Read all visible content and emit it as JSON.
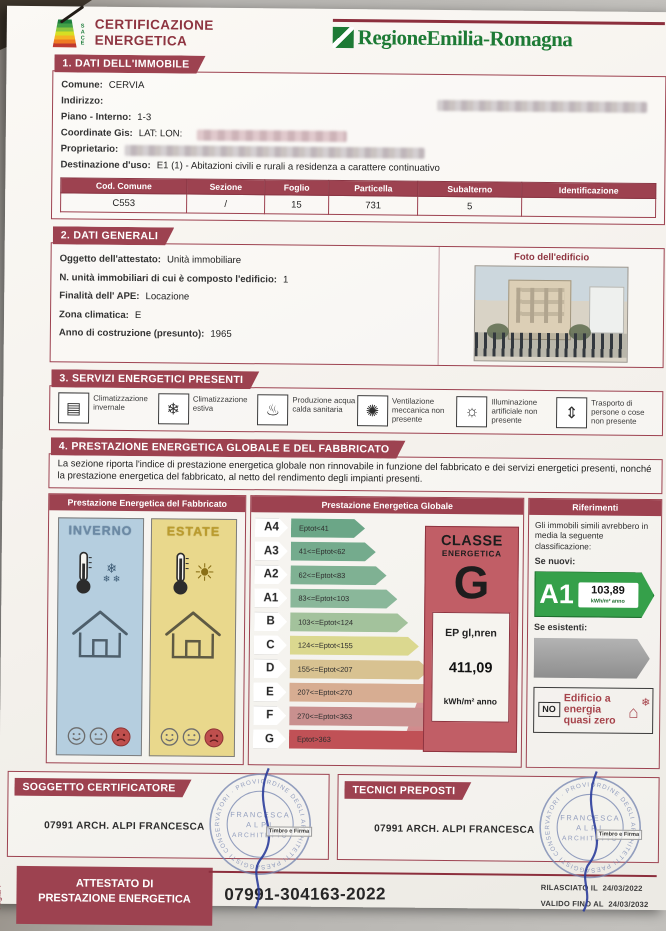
{
  "page": {
    "page_label": "Pag.1/4"
  },
  "header": {
    "cert_line1": "CERTIFICAZIONE",
    "cert_line2": "ENERGETICA",
    "sace_letters": [
      "S",
      "A",
      "C",
      "E"
    ],
    "region": "RegioneEmilia-Romagna"
  },
  "section1": {
    "title": "1. DATI DELL'IMMOBILE",
    "comune_label": "Comune:",
    "comune": "CERVIA",
    "indirizzo_label": "Indirizzo:",
    "piano_label": "Piano - Interno:",
    "piano": "1-3",
    "gis_label": "Coordinate Gis:",
    "gis": "LAT: LON:",
    "proprietario_label": "Proprietario:",
    "destinazione_label": "Destinazione d'uso:",
    "destinazione": "E1 (1) - Abitazioni civili e rurali a residenza a carattere continuativo",
    "table_headers": [
      "Cod. Comune",
      "Sezione",
      "Foglio",
      "Particella",
      "Subalterno",
      "Identificazione"
    ],
    "table_row": [
      "C553",
      "/",
      "15",
      "731",
      "5",
      ""
    ]
  },
  "section2": {
    "title": "2. DATI GENERALI",
    "oggetto_label": "Oggetto dell'attestato:",
    "oggetto": "Unità immobiliare",
    "nunita_label": "N. unità immobiliari di cui è composto l'edificio:",
    "nunita": "1",
    "finalita_label": "Finalità dell' APE:",
    "finalita": "Locazione",
    "zona_label": "Zona climatica:",
    "zona": "E",
    "anno_label": "Anno di costruzione (presunto):",
    "anno": "1965",
    "photo_label": "Foto dell'edificio"
  },
  "section3": {
    "title": "3. SERVIZI ENERGETICI PRESENTI",
    "services": [
      {
        "icon": "radiator-icon",
        "glyph": "▤",
        "label": "Climatizzazione invernale"
      },
      {
        "icon": "cooling-icon",
        "glyph": "❄",
        "label": "Climatizzazione estiva"
      },
      {
        "icon": "hot-water-icon",
        "glyph": "♨",
        "label": "Produzione acqua calda sanitaria"
      },
      {
        "icon": "ventilation-icon",
        "glyph": "✺",
        "label": "Ventilazione meccanica non presente"
      },
      {
        "icon": "lighting-icon",
        "glyph": "☼",
        "label": "Illuminazione artificiale non presente"
      },
      {
        "icon": "elevator-icon",
        "glyph": "⇕",
        "label": "Trasporto di persone o cose non presente"
      }
    ]
  },
  "section4": {
    "title": "4. PRESTAZIONE ENERGETICA GLOBALE E DEL FABBRICATO",
    "intro": "La sezione riporta l'indice di prestazione energetica globale non rinnovabile in funzione del fabbricato e dei servizi energetici presenti, nonché la prestazione energetica del fabbricato, al netto del rendimento degli impianti presenti.",
    "fabbricato_header": "Prestazione Energetica del Fabbricato",
    "inverno_title": "INVERNO",
    "estate_title": "ESTATE",
    "globale_header": "Prestazione Energetica Globale",
    "classes": [
      {
        "cls": "A4",
        "range": "Eptot<41",
        "color": "#6ba687",
        "w": "74px"
      },
      {
        "cls": "A3",
        "range": "41<=Eptot<62",
        "color": "#74ab8d",
        "w": "85px"
      },
      {
        "cls": "A2",
        "range": "62<=Eptot<83",
        "color": "#7fb193",
        "w": "96px"
      },
      {
        "cls": "A1",
        "range": "83<=Eptot<103",
        "color": "#8ab79a",
        "w": "107px"
      },
      {
        "cls": "B",
        "range": "103<=Eptot<124",
        "color": "#a3c29c",
        "w": "118px"
      },
      {
        "cls": "C",
        "range": "124<=Eptot<155",
        "color": "#dbd88f",
        "w": "129px"
      },
      {
        "cls": "D",
        "range": "155<=Eptot<207",
        "color": "#d8c291",
        "w": "140px"
      },
      {
        "cls": "E",
        "range": "207<=Eptot<270",
        "color": "#d7ad92",
        "w": "151px"
      },
      {
        "cls": "F",
        "range": "270<=Eptot<363",
        "color": "#c9908f",
        "w": "162px"
      },
      {
        "cls": "G",
        "range": "Eptot>363",
        "color": "#c05156",
        "w": "178px"
      }
    ],
    "classe_box": {
      "title1": "CLASSE",
      "title2": "ENERGETICA",
      "letter": "G",
      "ep_label": "EP gl,nren",
      "ep_value": "411,09",
      "ep_unit": "kWh/m² anno"
    },
    "riferimenti_header": "Riferimenti",
    "rif_text": "Gli immobili simili avrebbero in media la seguente classificazione:",
    "se_nuovi": "Se nuovi:",
    "nuovi_cls": "A1",
    "nuovi_val": "103,89",
    "nuovi_unit": "kWh/m² anno",
    "se_esistenti": "Se esistenti:",
    "nzeb_no": "NO",
    "nzeb_text": "Edificio a energia quasi zero"
  },
  "footer": {
    "soggetto_title": "SOGGETTO CERTIFICATORE",
    "soggetto_name": "07991 ARCH. ALPI FRANCESCA",
    "tecnici_title": "TECNICI PREPOSTI",
    "tecnici_name": "07991 ARCH. ALPI FRANCESCA",
    "stamp_ring": "ORDINE DEGLI ARCHITETTI PAESAGGISTI CONSERVATORI · PROVINCIA DI RAVENNA ·",
    "stamp_center1": "FRANCESCA",
    "stamp_center2": "ALPI",
    "stamp_center3": "ARCHITETTO",
    "timbro_label": "Timbro e Firma",
    "attestato_title1": "ATTESTATO DI",
    "attestato_title2": "PRESTAZIONE ENERGETICA",
    "code": "07991-304163-2022",
    "rilasciato_label": "RILASCIATO IL",
    "rilasciato_date": "24/03/2022",
    "valido_label": "VALIDO FINO AL",
    "valido_date": "24/03/2032"
  },
  "colors": {
    "banner_red": "#9d4250",
    "region_green": "#1d7a35",
    "classe_box_bg": "#c15e66",
    "a1_green": "#35a04a"
  }
}
